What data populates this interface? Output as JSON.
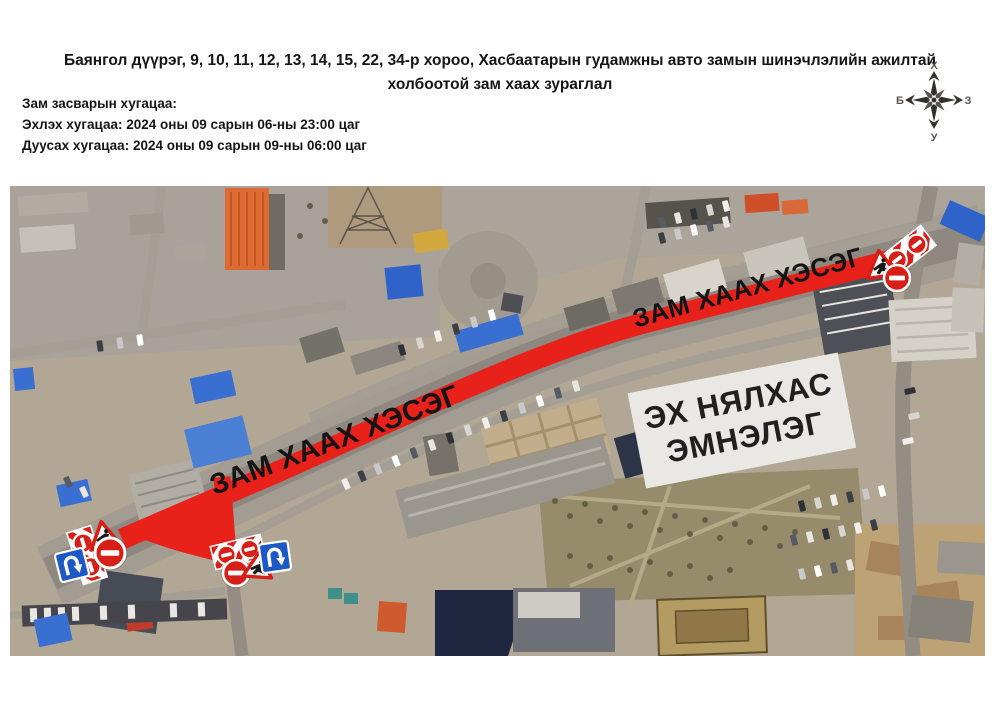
{
  "header": {
    "title_line1": "Баянгол дүүрэг, 9, 10, 11, 12, 13, 14, 15, 22, 34-р хороо, Хасбаатарын гудамжны авто замын шинэчлэлийн ажилтай",
    "title_line2": "холбоотой  зам хаах зураглал",
    "schedule": {
      "heading": "Зам засварын хугацаа:",
      "start": "Эхлэх хугацаа: 2024 оны 09 сарын 06-ны 23:00 цаг",
      "end": "Дуусах хугацаа: 2024 оны 09 сарын 09-ны 06:00 цаг"
    }
  },
  "compass": {
    "north_label": "Х",
    "south_label": "У",
    "east_label": "З",
    "west_label": "Б"
  },
  "map": {
    "closure_label": "ЗАМ ХААХ ХЭСЭГ",
    "hospital_label_line1": "ЭХ НЯЛХАС",
    "hospital_label_line2": "ЭМНЭЛЭГ",
    "colors": {
      "closure_red": "#e8211a",
      "sign_red": "#d81f17",
      "sign_blue": "#1d59c6",
      "hospital_box_bg": "#eae8e4",
      "label_text": "#141414"
    }
  }
}
